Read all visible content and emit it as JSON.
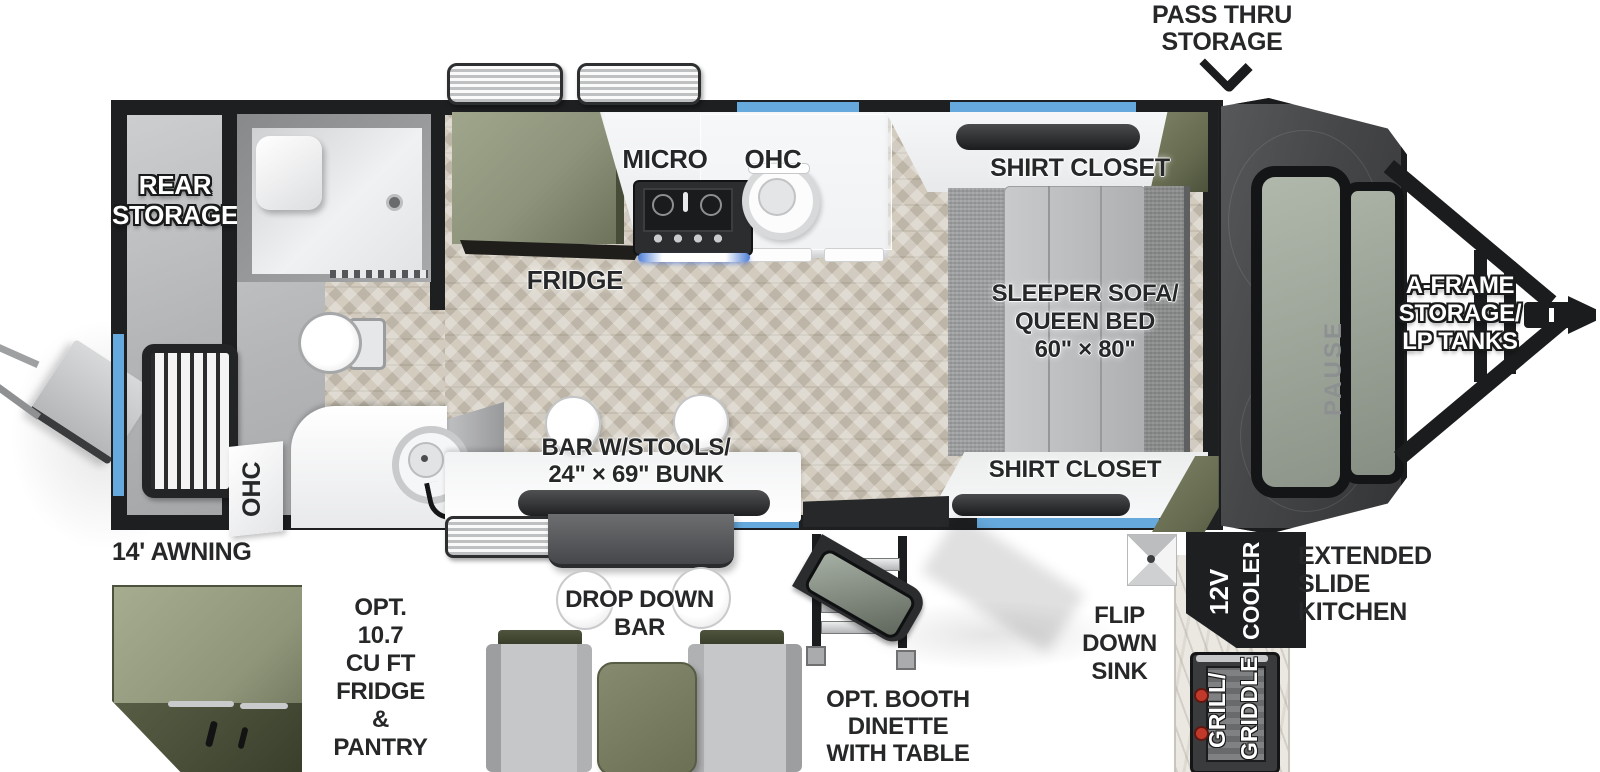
{
  "title": "Travel trailer floor plan",
  "colors": {
    "accent_blue": "#66a9dc",
    "olive_green": "#6e735a",
    "wall_black": "#1e1f21",
    "floor_tan": "#d3ccbe",
    "label_dark": "#262729"
  },
  "labels": {
    "pass_thru": [
      "PASS THRU",
      "STORAGE"
    ],
    "rear_storage": [
      "REAR",
      "STORAGE"
    ],
    "micro": "MICRO",
    "ohc_kitchen": "OHC",
    "shirt_closet_top": "SHIRT CLOSET",
    "fridge": "FRIDGE",
    "sleeper": [
      "SLEEPER SOFA/",
      "QUEEN BED",
      "60\" × 80\""
    ],
    "ohc_bath": "OHC",
    "bar_bunk": [
      "BAR W/STOOLS/",
      "24\" × 69\" BUNK"
    ],
    "shirt_closet_bottom": "SHIRT CLOSET",
    "a_frame": [
      "A-FRAME",
      "STORAGE/",
      "LP TANKS"
    ],
    "awning": "14' AWNING",
    "opt_fridge": [
      "OPT.",
      "10.7",
      "CU FT",
      "FRIDGE",
      "&",
      "PANTRY"
    ],
    "drop_down_bar": [
      "DROP DOWN",
      "BAR"
    ],
    "booth": [
      "OPT. BOOTH",
      "DINETTE",
      "WITH TABLE"
    ],
    "flip_sink": [
      "FLIP",
      "DOWN",
      "SINK"
    ],
    "cooler": [
      "12V",
      "COOLER"
    ],
    "slide_kitchen": [
      "EXTENDED",
      "SLIDE",
      "KITCHEN"
    ],
    "grill": [
      "GRILL/",
      "GRIDDLE"
    ],
    "brand": "PAUSE"
  }
}
